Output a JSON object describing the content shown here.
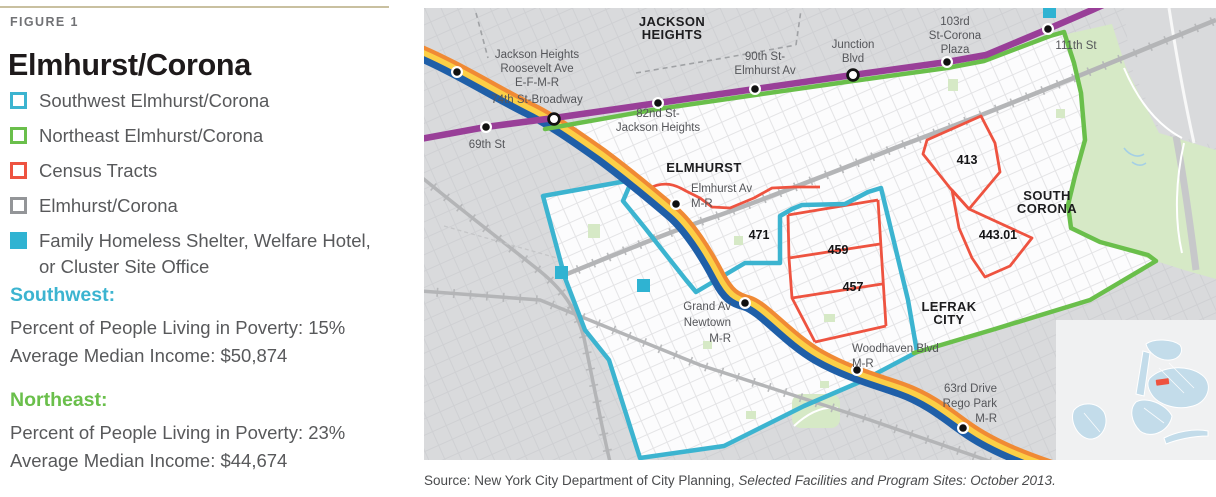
{
  "figure": {
    "label": "FIGURE 1",
    "title": "Elmhurst/Corona"
  },
  "legend": [
    "Southwest Elmhurst/Corona",
    "Northeast Elmhurst/Corona",
    "Census Tracts",
    "Elmhurst/Corona",
    "Family Homeless Shelter, Welfare Hotel, or Cluster Site Office"
  ],
  "stats": [
    {
      "heading": "Southwest:",
      "lines": [
        "Percent of People Living in Poverty: 15%",
        "Average Median Income: $50,874"
      ]
    },
    {
      "heading": "Northeast:",
      "lines": [
        "Percent of People Living in Poverty: 23%",
        "Average Median Income: $44,674"
      ]
    }
  ],
  "map": {
    "neighborhoods": [
      [
        "JACKSON",
        "HEIGHTS"
      ],
      [
        "ELMHURST"
      ],
      [
        "SOUTH",
        "CORONA"
      ],
      [
        "LEFRAK",
        "CITY"
      ]
    ],
    "stations": [
      [
        "Jackson Heights",
        "Roosevelt Ave",
        "E-F-M-R",
        "74th St-Broadway"
      ],
      [
        "69th St"
      ],
      [
        "82nd St-",
        "Jackson Heights"
      ],
      [
        "90th St-",
        "Elmhurst Av"
      ],
      [
        "Junction",
        "Blvd"
      ],
      [
        "103rd",
        "St-Corona",
        "Plaza"
      ],
      [
        "111th St"
      ],
      [
        "Elmhurst Av",
        "M-R"
      ],
      [
        "Grand Av",
        "Newtown",
        "M-R"
      ],
      [
        "Woodhaven Blvd",
        "M-R"
      ],
      [
        "63rd Drive",
        "Rego Park",
        "M-R"
      ]
    ],
    "tracts": [
      "471",
      "459",
      "457",
      "413",
      "443.01"
    ],
    "source_prefix": "Source: New York City Department of City Planning, ",
    "source_italic": "Selected Facilities and Program Sites: October 2013."
  },
  "colors": {
    "southwest_teal": "#3cb4d0",
    "northeast_green": "#6abf4b",
    "census_red": "#ee5340",
    "boundary_gray": "#939598",
    "shelter_cyan": "#2fb3d2",
    "subway_purple": "#993f98",
    "subway_blue": "#1f5fa8",
    "subway_yellow": "#fccf46",
    "subway_orange": "#f08a34"
  }
}
